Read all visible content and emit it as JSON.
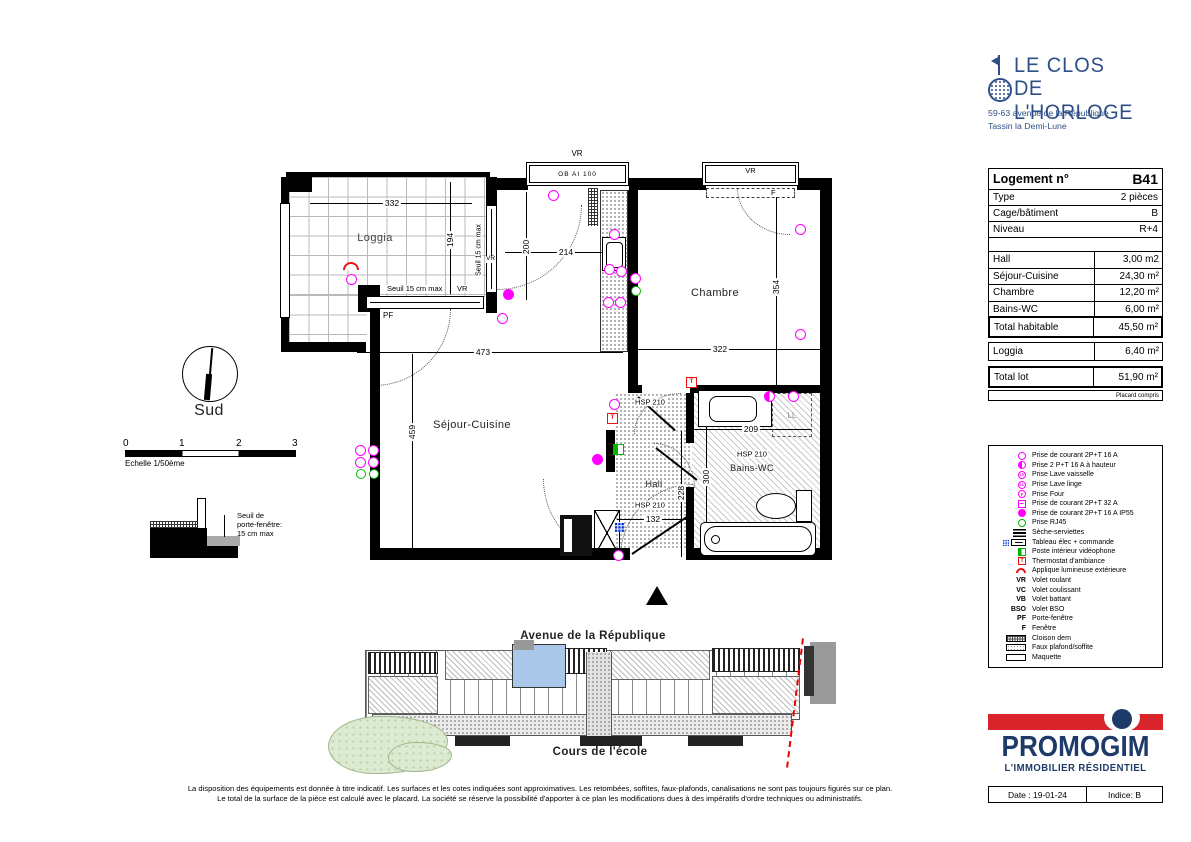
{
  "brand": {
    "name_line1": "LE CLOS",
    "name_line2": "DE L'HORLOGE",
    "address_line1": "59-63 avenue de la République",
    "address_line2": "Tassin la Demi-Lune"
  },
  "info_table": {
    "title_label": "Logement n°",
    "title_value": "B41",
    "rows": [
      {
        "label": "Type",
        "value": "2 pièces"
      },
      {
        "label": "Cage/bâtiment",
        "value": "B"
      },
      {
        "label": "Niveau",
        "value": "R+4"
      }
    ],
    "areas": [
      {
        "label": "Hall",
        "value": "3,00 m2"
      },
      {
        "label": "Séjour-Cuisine",
        "value": "24,30 m²"
      },
      {
        "label": "Chambre",
        "value": "12,20 m²"
      },
      {
        "label": "Bains-WC",
        "value": "6,00 m²"
      }
    ],
    "total_hab_label": "Total habitable",
    "total_hab_value": "45,50 m²",
    "loggia_label": "Loggia",
    "loggia_value": "6,40 m²",
    "total_lot_label": "Total lot",
    "total_lot_value": "51,90 m²",
    "note": "Placard compris"
  },
  "legend": {
    "items": [
      {
        "icon": "socket-16a",
        "label": "Prise de courant 2P+T 16 A"
      },
      {
        "icon": "socket-height",
        "label": "Prise 2 P+T 16 A à hauteur"
      },
      {
        "icon": "socket-dishwasher",
        "glyph": "LV",
        "label": "Prise Lave vaisselle"
      },
      {
        "icon": "socket-washer",
        "glyph": "LL",
        "label": "Prise Lave linge"
      },
      {
        "icon": "socket-oven",
        "glyph": "F",
        "label": "Prise Four"
      },
      {
        "icon": "socket-32a",
        "label": "Prise de courant 2P+T 32 A"
      },
      {
        "icon": "socket-ip55",
        "label": "Prise de courant 2P+T 16 A IP55"
      },
      {
        "icon": "rj45",
        "label": "Prise RJ45"
      },
      {
        "icon": "towel-dryer",
        "label": "Sèche-serviettes"
      },
      {
        "icon": "electrical-panel",
        "label": "Tableau élec + commande"
      },
      {
        "icon": "videophone",
        "label": "Poste intérieur vidéophone"
      },
      {
        "icon": "thermostat",
        "glyph": "T",
        "label": "Thermostat d'ambiance"
      },
      {
        "icon": "outdoor-light",
        "label": "Applique lumineuse extérieure"
      },
      {
        "abbr": "VR",
        "label": "Volet roulant"
      },
      {
        "abbr": "VC",
        "label": "Volet coulissant"
      },
      {
        "abbr": "VB",
        "label": "Volet battant"
      },
      {
        "abbr": "BSO",
        "label": "Volet BSO"
      },
      {
        "abbr": "PF",
        "label": "Porte-fenêtre"
      },
      {
        "abbr": "F",
        "label": "Fenêtre"
      },
      {
        "icon": "partition",
        "label": "Cloison dem"
      },
      {
        "icon": "false-ceiling",
        "label": "Faux plafond/soffite"
      },
      {
        "icon": "model",
        "label": "Maquette"
      }
    ]
  },
  "plan": {
    "rooms": {
      "loggia": "Loggia",
      "chambre": "Chambre",
      "sejour": "Séjour-Cuisine",
      "hall": "Hall",
      "bains": "Bains-WC"
    },
    "dims": {
      "loggia_w": "332",
      "loggia_d": "194",
      "kitchen_w": "214",
      "kitchen_d": "200",
      "sejour_w": "473",
      "sejour_d": "459",
      "chambre_w": "322",
      "chambre_d": "354",
      "bains_w": "209",
      "bains_d": "300",
      "hall_d": "228",
      "hall_w": "132"
    },
    "labels": {
      "vr": "VR",
      "pf": "PF",
      "f": "F",
      "window_spec": "OB AI 100",
      "seuil": "Seuil 15 cm max",
      "hsp": "HSP 210",
      "ll": "LL"
    }
  },
  "compass": {
    "label": "Sud"
  },
  "scale_bar": {
    "t0": "0",
    "t1": "1",
    "t2": "2",
    "t3": "3",
    "label": "Echelle 1/50ème"
  },
  "seuil_detail": {
    "line1": "Seuil de",
    "line2": "porte-fenêtre:",
    "line3": "15 cm max"
  },
  "site_plan": {
    "street_top": "Avenue de la République",
    "street_bottom": "Cours de l'école"
  },
  "promogim": {
    "name": "PROMOGIM",
    "tagline": "L'IMMOBILIER  RÉSIDENTIEL",
    "date": "Date : 19-01-24",
    "indice": "Indice: B"
  },
  "footer": {
    "line1": "La disposition des équipements est donnée à titre indicatif. Les surfaces et les cotes indiquées sont approximatives. Les retombées, soffites, faux-plafonds, canalisations ne sont pas toujours figurés sur ce plan.",
    "line2": "Le total de la surface de la pièce est calculé avec le placard. La société se réserve la possibilité d'apporter à ce plan les modifications dues à des impératifs d'ordre techniques ou administratifs."
  },
  "colors": {
    "brand_blue": "#2d4f87",
    "promogim_blue": "#1d3a68",
    "promogim_red": "#d9242b",
    "socket_magenta": "#ff00ff",
    "rj45_green": "#00b400",
    "panel_blue": "#0033dd",
    "alert_red": "#ee1111",
    "unit_highlight": "#a9c7e9",
    "vegetation": "#dcead2"
  }
}
